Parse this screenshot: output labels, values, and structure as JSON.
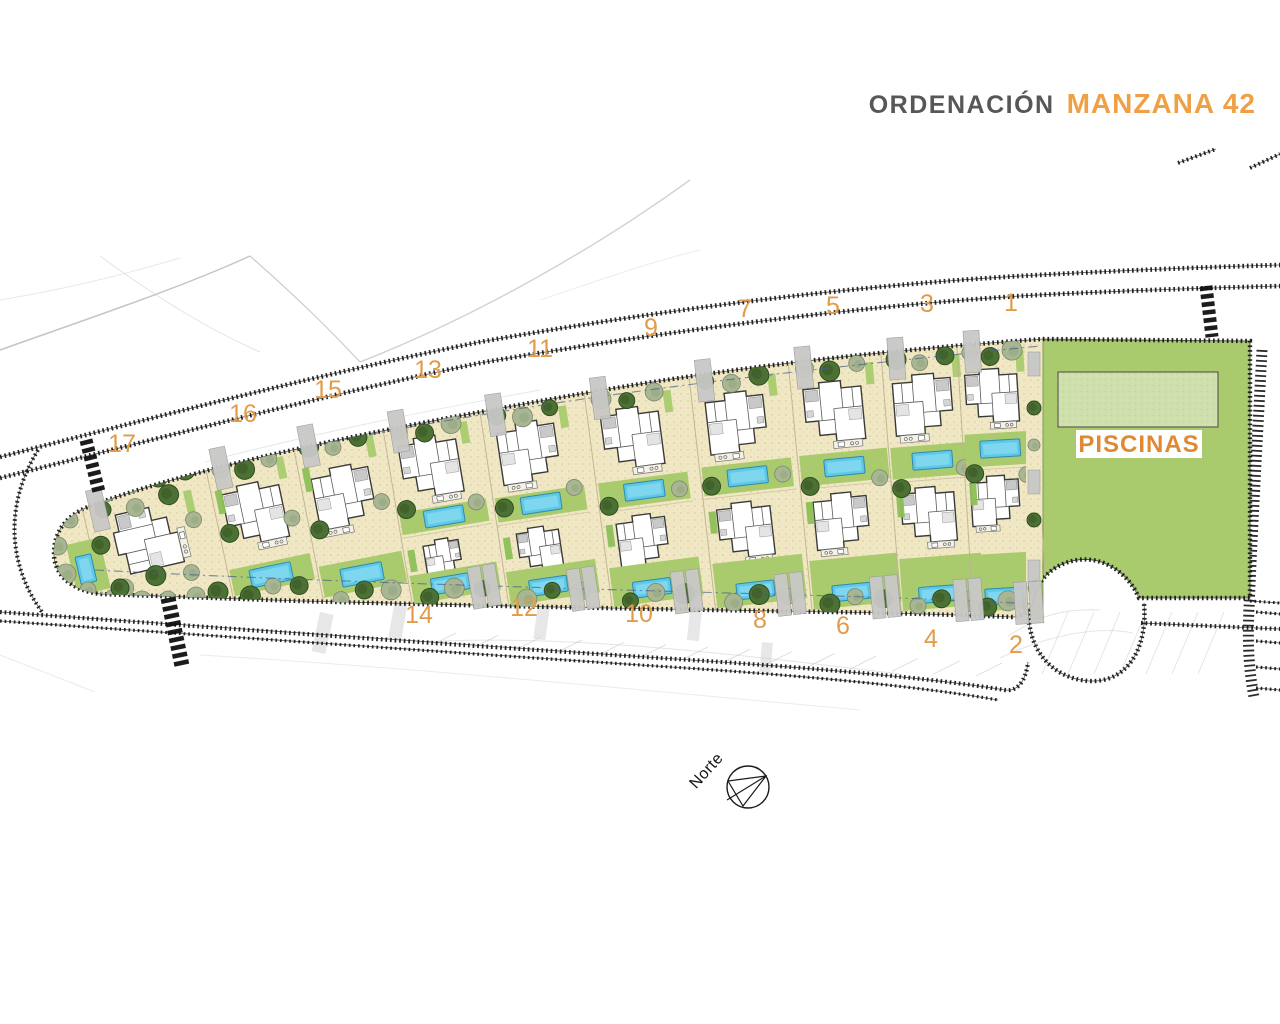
{
  "title": {
    "prefix": "ORDENACIÓN",
    "highlight": "MANZANA 42"
  },
  "labels": {
    "pools_area": "PISCINAS",
    "compass_north": "Norte"
  },
  "colors": {
    "accent_orange": "#EFA044",
    "plot_number_orange": "#E39B4A",
    "pools_label_orange": "#DF8A33",
    "title_gray": "#575756",
    "lawn_green": "#A9CB6E",
    "pools_zone_green": "#CFE0AC",
    "pool_blue": "#5EC9E6",
    "sand": "#F0E7C4",
    "tree_dark_green": "#4C7134",
    "tree_sage_green": "#A9B693"
  },
  "plots": [
    {
      "number": "1",
      "row": "top",
      "label_x": 1011,
      "label_y": 311
    },
    {
      "number": "2",
      "row": "bottom",
      "label_x": 1016,
      "label_y": 653
    },
    {
      "number": "3",
      "row": "top",
      "label_x": 927,
      "label_y": 312
    },
    {
      "number": "4",
      "row": "bottom",
      "label_x": 931,
      "label_y": 647
    },
    {
      "number": "5",
      "row": "top",
      "label_x": 833,
      "label_y": 314
    },
    {
      "number": "6",
      "row": "bottom",
      "label_x": 843,
      "label_y": 634
    },
    {
      "number": "7",
      "row": "top",
      "label_x": 745,
      "label_y": 317
    },
    {
      "number": "8",
      "row": "bottom",
      "label_x": 760,
      "label_y": 628
    },
    {
      "number": "9",
      "row": "top",
      "label_x": 651,
      "label_y": 336
    },
    {
      "number": "10",
      "row": "bottom",
      "label_x": 639,
      "label_y": 622
    },
    {
      "number": "11",
      "row": "top",
      "label_x": 540,
      "label_y": 357
    },
    {
      "number": "12",
      "row": "bottom",
      "label_x": 524,
      "label_y": 616
    },
    {
      "number": "13",
      "row": "top",
      "label_x": 428,
      "label_y": 378
    },
    {
      "number": "14",
      "row": "bottom",
      "label_x": 419,
      "label_y": 623
    },
    {
      "number": "15",
      "row": "top",
      "label_x": 328,
      "label_y": 398
    },
    {
      "number": "16",
      "row": "top",
      "label_x": 243,
      "label_y": 422
    },
    {
      "number": "17",
      "row": "top",
      "label_x": 122,
      "label_y": 452
    }
  ]
}
